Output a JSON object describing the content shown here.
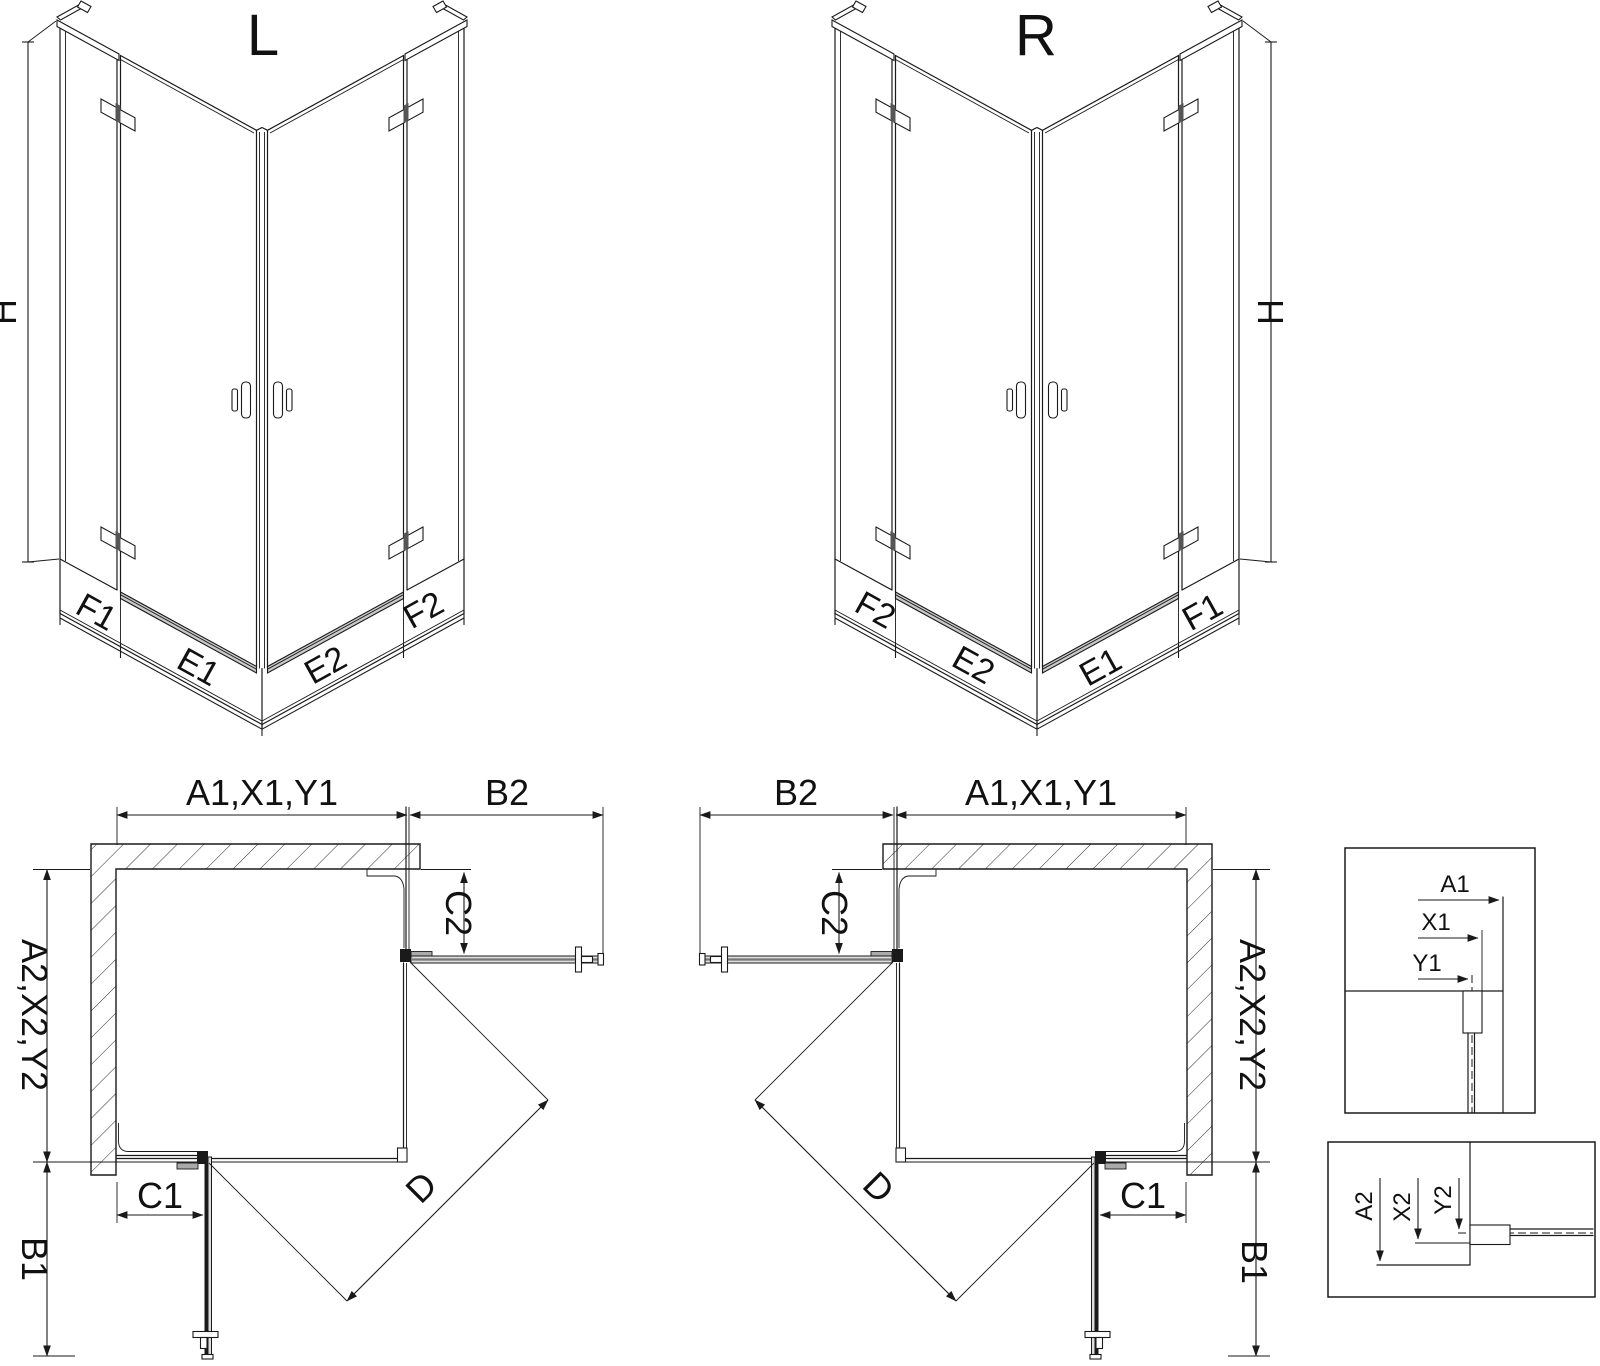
{
  "drawing": {
    "iso_l": {
      "title": "L",
      "dim_h": "H",
      "dim_f1": "F1",
      "dim_e1": "E1",
      "dim_e2": "E2",
      "dim_f2": "F2"
    },
    "iso_r": {
      "title": "R",
      "dim_h": "H",
      "dim_f2": "F2",
      "dim_e2": "E2",
      "dim_e1": "E1",
      "dim_f1": "F1"
    },
    "plan_l": {
      "dim_top": "A1,X1,Y1",
      "dim_b2": "B2",
      "dim_c2": "C2",
      "dim_left": "A2,X2,Y2",
      "dim_b1": "B1",
      "dim_c1": "C1",
      "dim_d": "D"
    },
    "plan_r": {
      "dim_top": "A1,X1,Y1",
      "dim_b2": "B2",
      "dim_c2": "C2",
      "dim_right": "A2,X2,Y2",
      "dim_b1": "B1",
      "dim_c1": "C1",
      "dim_d": "D"
    },
    "detail_1": {
      "dim_a1": "A1",
      "dim_x1": "X1",
      "dim_y1": "Y1"
    },
    "detail_2": {
      "dim_a2": "A2",
      "dim_x2": "X2",
      "dim_y2": "Y2"
    },
    "colors": {
      "line": "#1a1a1a",
      "metal": "#c9c9c9",
      "background": "#ffffff"
    }
  }
}
